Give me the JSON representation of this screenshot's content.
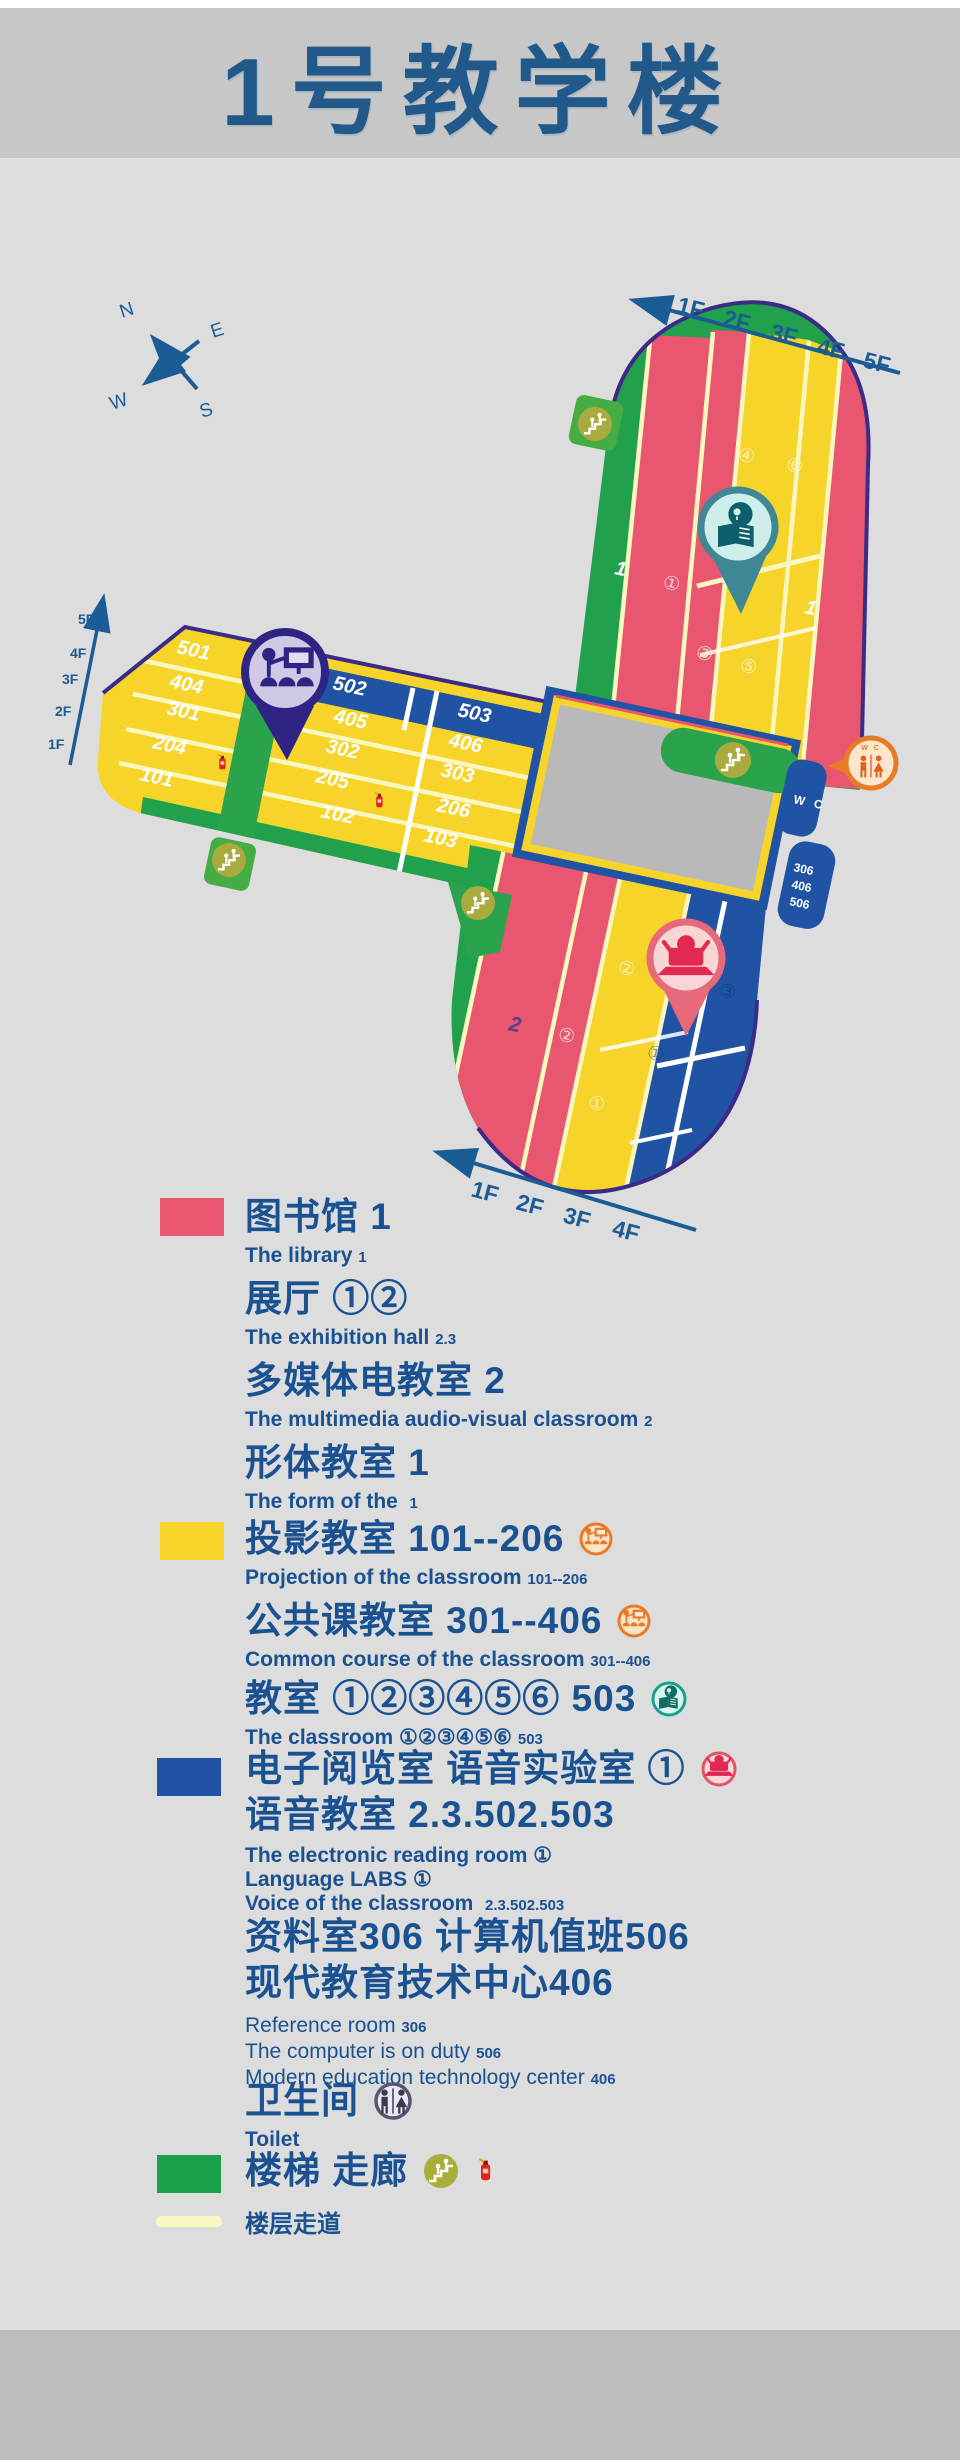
{
  "header": {
    "title": "1号教学楼"
  },
  "compass": {
    "n": "N",
    "e": "E",
    "w": "W",
    "s": "S"
  },
  "colors": {
    "pink": "#e8566f",
    "yellow": "#f6d42a",
    "blue": "#2053a4",
    "green": "#22a14c",
    "outline_purple": "#3b2a86",
    "text_blue": "#1a5191",
    "pale_path": "#f8f7c0"
  },
  "map": {
    "arrows": {
      "top": [
        "1F",
        "2F",
        "3F",
        "4F",
        "5F"
      ],
      "left": [
        "5F",
        "4F",
        "3F",
        "2F",
        "1F"
      ],
      "bottom": [
        "1F",
        "2F",
        "3F",
        "4F"
      ]
    },
    "north": {
      "pink_left": "1",
      "c1": "①",
      "c4": "④",
      "c6": "⑥",
      "c3": "③",
      "c5": "⑤",
      "pink_right": "1"
    },
    "west": {
      "left_rows": [
        "501",
        "404",
        "301",
        "204",
        "101"
      ],
      "band_502": "502",
      "band_503": "503",
      "mid_rows": [
        "405",
        "302",
        "205",
        "102"
      ],
      "right_rows": [
        "406",
        "303",
        "206",
        "103"
      ]
    },
    "south": {
      "two": "2",
      "c2": "②",
      "y2": "②",
      "y1": "①",
      "b3": "③",
      "b1": "①"
    },
    "wc_tab": "W C",
    "wc_pin": "W C",
    "side_rooms": [
      "306",
      "406",
      "506"
    ]
  },
  "legend": {
    "items": [
      {
        "title": "图书馆 1",
        "sub": "The library",
        "subnum": "1"
      },
      {
        "title": "展厅 ①②",
        "sub": "The exhibition hall",
        "subnum": "2.3"
      },
      {
        "title": "多媒体电教室 2",
        "sub": "The multimedia audio-visual classroom",
        "subnum": "2"
      },
      {
        "title": "形体教室 1",
        "sub": "The form of the",
        "subnum": "1"
      },
      {
        "title": "投影教室 101--206",
        "sub": "Projection of the classroom",
        "subnum": "101--206"
      },
      {
        "title": "公共课教室 301--406",
        "sub": "Common course of the classroom",
        "subnum": "301--406"
      },
      {
        "title": "教室 ①②③④⑤⑥ 503",
        "sub": "The classroom ①②③④⑤⑥",
        "subnum": "503"
      },
      {
        "title": "电子阅览室 语音实验室 ①",
        "title2": "语音教室 2.3.502.503",
        "sub1": "The electronic reading room ①",
        "sub2": "Language LABS ①",
        "sub3": "Voice of the classroom",
        "sub3num": "2.3.502.503"
      },
      {
        "title": "资料室306 计算机值班506",
        "title2": "现代教育技术中心406",
        "sub1": "Reference room",
        "sub1num": "306",
        "sub2": "The computer is on duty",
        "sub2num": "506",
        "sub3": "Modern education technology center",
        "sub3num": "406"
      },
      {
        "title": "卫生间",
        "sub": "Toilet"
      },
      {
        "title": "楼梯 走廊"
      },
      {
        "title": "楼层走道"
      }
    ]
  }
}
